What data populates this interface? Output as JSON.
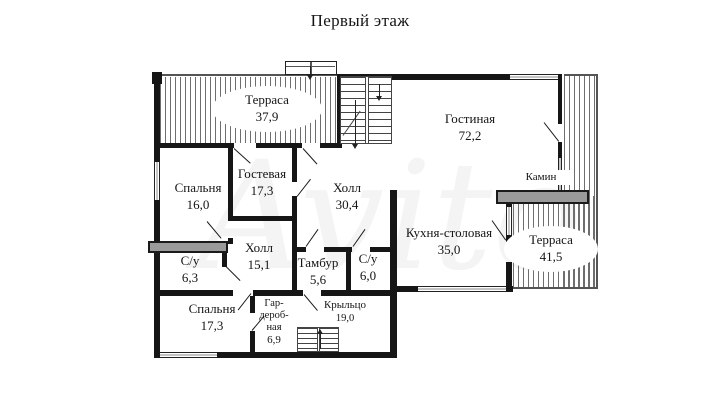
{
  "title": "Первый этаж",
  "watermark": "Avito",
  "plan": {
    "rooms": {
      "terrace_top": {
        "name": "Терраса",
        "area": "37,9"
      },
      "living_room": {
        "name": "Гостиная",
        "area": "72,2"
      },
      "fireplace": {
        "name": "Камин"
      },
      "terrace_right": {
        "name": "Терраса",
        "area": "41,5"
      },
      "bedroom_1": {
        "name": "Спальня",
        "area": "16,0"
      },
      "guest_room": {
        "name": "Гостевая",
        "area": "17,3"
      },
      "hall_main": {
        "name": "Холл",
        "area": "30,4"
      },
      "kitchen_dining": {
        "name": "Кухня-столовая",
        "area": "35,0"
      },
      "hall_small": {
        "name": "Холл",
        "area": "15,1"
      },
      "bathroom_1": {
        "name": "С/у",
        "area": "6,3"
      },
      "vestibule": {
        "name": "Тамбур",
        "area": "5,6"
      },
      "bathroom_2": {
        "name": "С/у",
        "area": "6,0"
      },
      "bedroom_2": {
        "name": "Спальня",
        "area": "17,3"
      },
      "wardrobe": {
        "name": "Гар-\nдероб-\nная",
        "area": "6,9"
      },
      "porch": {
        "name": "Крыльцо",
        "area": "19,0"
      }
    }
  }
}
